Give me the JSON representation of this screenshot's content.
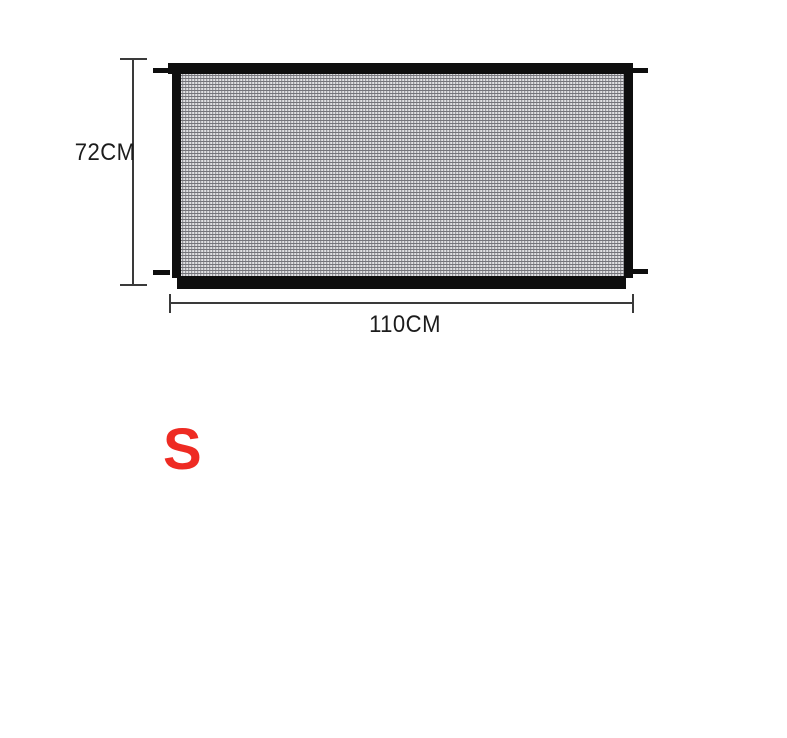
{
  "product_diagram": {
    "item": "mesh-safety-gate",
    "annotations": {
      "height_label": "72CM",
      "width_label": "110CM"
    },
    "size_option": "S"
  },
  "colors": {
    "frame_black": "#0e0e0e",
    "mesh_base": "#b2b2b6",
    "mesh_light": "#e2e2e4",
    "mesh_dark": "#74747a",
    "dimension_line": "#3a3a3a",
    "dimension_text": "#1c1c1c",
    "size_label": "#ee2b23",
    "background": "#ffffff"
  }
}
